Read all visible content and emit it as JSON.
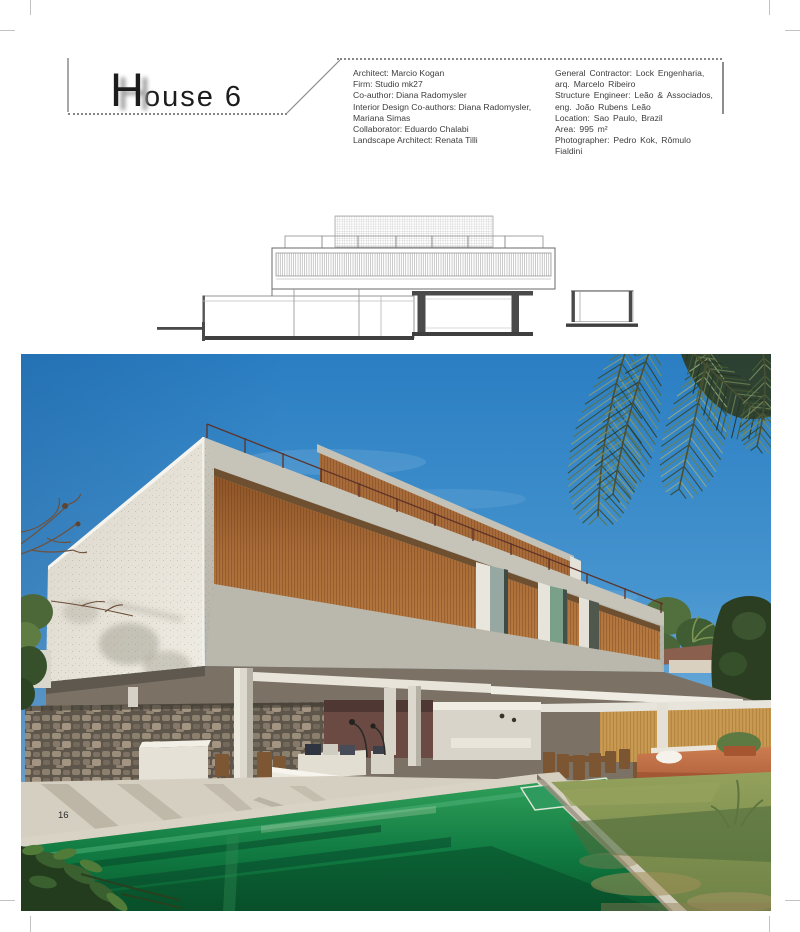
{
  "page": {
    "number": "16"
  },
  "header": {
    "title": {
      "initial": "H",
      "rest": "ouse 6"
    },
    "credits": {
      "left": [
        "Architect: Marcio Kogan",
        "Firm: Studio mk27",
        "Co-author: Diana Radomysler",
        "Interior Design Co-authors: Diana Radomysler,",
        "Mariana Simas",
        "Collaborator: Eduardo Chalabi",
        "Landscape Architect: Renata Tilli"
      ],
      "right": [
        "General Contractor: Lock Engenharia,",
        "arq. Marcelo Ribeiro",
        "Structure Engineer: Leão & Associados,",
        "eng. João Rubens Leão",
        "Location: Sao Paulo, Brazil",
        "Area: 995 m²",
        "Photographer: Pedro Kok, Rômulo",
        "Fialdini"
      ]
    }
  },
  "palette": {
    "sky_blue": "#3a8ecb",
    "wood_brown": "#a96c38",
    "light_wood": "#c99a52",
    "pool_green": "#0f7a40",
    "lawn_green": "#7b8d4d",
    "terracotta": "#bc6a44",
    "concrete_gray": "#c5c2b8"
  }
}
